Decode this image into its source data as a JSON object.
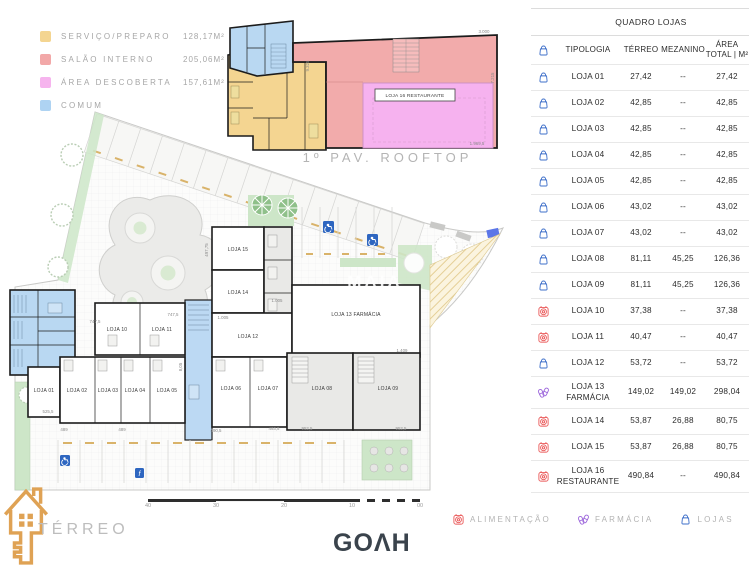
{
  "area_legend": {
    "items": [
      {
        "label": "SERVIÇO/PREPARO",
        "value": "128,17M²",
        "color": "#f4d591"
      },
      {
        "label": "SALÃO INTERNO",
        "value": "205,06M²",
        "color": "#f2a8a8"
      },
      {
        "label": "ÁREA DESCOBERTA",
        "value": "157,61M²",
        "color": "#f6b4ee"
      },
      {
        "label": "COMUM",
        "value": "",
        "color": "#aed3f2"
      }
    ]
  },
  "rooftop": {
    "title": "1º PAV. ROOFTOP",
    "restaurant_label": "LOJA 16 RESTAURANTE",
    "dims": {
      "left": "9.325",
      "top_right": "3.000",
      "right": "7.215",
      "bottom_right": "1.969,5"
    }
  },
  "terreo": {
    "title": "TÉRREO",
    "watermark": "MAIA",
    "lojas": [
      "LOJA 01",
      "LOJA 02",
      "LOJA 03",
      "LOJA 04",
      "LOJA 05",
      "LOJA 06",
      "LOJA 07",
      "LOJA 08",
      "LOJA 09",
      "LOJA 10",
      "LOJA 11",
      "LOJA 12",
      "LOJA 13 FARMÁCIA",
      "LOJA 14",
      "LOJA 15"
    ],
    "dims": [
      "747,5",
      "747,5",
      "1.005",
      "1.005",
      "525,5",
      "489",
      "489",
      "490,5",
      "493,5",
      "952,5",
      "952,5",
      "1.409",
      "497,75",
      "8,05"
    ],
    "scale_ticks": [
      "40",
      "30",
      "20",
      "10",
      "00"
    ]
  },
  "quadro_lojas": {
    "title": "QUADRO LOJAS",
    "columns": {
      "tipologia": "TIPOLOGIA",
      "terreo": "TÉRREO",
      "mezanino": "MEZANINO",
      "area_total": "ÁREA TOTAL | M²"
    },
    "rows": [
      {
        "icon": "lojas",
        "name": "LOJA 01",
        "terreo": "27,42",
        "mezanino": "--",
        "total": "27,42"
      },
      {
        "icon": "lojas",
        "name": "LOJA 02",
        "terreo": "42,85",
        "mezanino": "--",
        "total": "42,85"
      },
      {
        "icon": "lojas",
        "name": "LOJA 03",
        "terreo": "42,85",
        "mezanino": "--",
        "total": "42,85"
      },
      {
        "icon": "lojas",
        "name": "LOJA 04",
        "terreo": "42,85",
        "mezanino": "--",
        "total": "42,85"
      },
      {
        "icon": "lojas",
        "name": "LOJA 05",
        "terreo": "42,85",
        "mezanino": "--",
        "total": "42,85"
      },
      {
        "icon": "lojas",
        "name": "LOJA 06",
        "terreo": "43,02",
        "mezanino": "--",
        "total": "43,02"
      },
      {
        "icon": "lojas",
        "name": "LOJA 07",
        "terreo": "43,02",
        "mezanino": "--",
        "total": "43,02"
      },
      {
        "icon": "lojas",
        "name": "LOJA 08",
        "terreo": "81,11",
        "mezanino": "45,25",
        "total": "126,36"
      },
      {
        "icon": "lojas",
        "name": "LOJA 09",
        "terreo": "81,11",
        "mezanino": "45,25",
        "total": "126,36"
      },
      {
        "icon": "alimentacao",
        "name": "LOJA 10",
        "terreo": "37,38",
        "mezanino": "--",
        "total": "37,38"
      },
      {
        "icon": "alimentacao",
        "name": "LOJA 11",
        "terreo": "40,47",
        "mezanino": "--",
        "total": "40,47"
      },
      {
        "icon": "lojas",
        "name": "LOJA 12",
        "terreo": "53,72",
        "mezanino": "--",
        "total": "53,72"
      },
      {
        "icon": "farmacia",
        "name": "LOJA 13 FARMÁCIA",
        "terreo": "149,02",
        "mezanino": "149,02",
        "total": "298,04"
      },
      {
        "icon": "alimentacao",
        "name": "LOJA 14",
        "terreo": "53,87",
        "mezanino": "26,88",
        "total": "80,75"
      },
      {
        "icon": "alimentacao",
        "name": "LOJA 15",
        "terreo": "53,87",
        "mezanino": "26,88",
        "total": "80,75"
      },
      {
        "icon": "alimentacao",
        "name": "LOJA 16 RESTAURANTE",
        "terreo": "490,84",
        "mezanino": "--",
        "total": "490,84"
      }
    ]
  },
  "category_legend": {
    "items": [
      {
        "label": "ALIMENTAÇÃO",
        "color": "#ea5a5a"
      },
      {
        "label": "FARMÁCIA",
        "color": "#9c66db"
      },
      {
        "label": "LOJAS",
        "color": "#3e6fc9"
      }
    ]
  },
  "branding": {
    "logo": "GOΛH"
  }
}
